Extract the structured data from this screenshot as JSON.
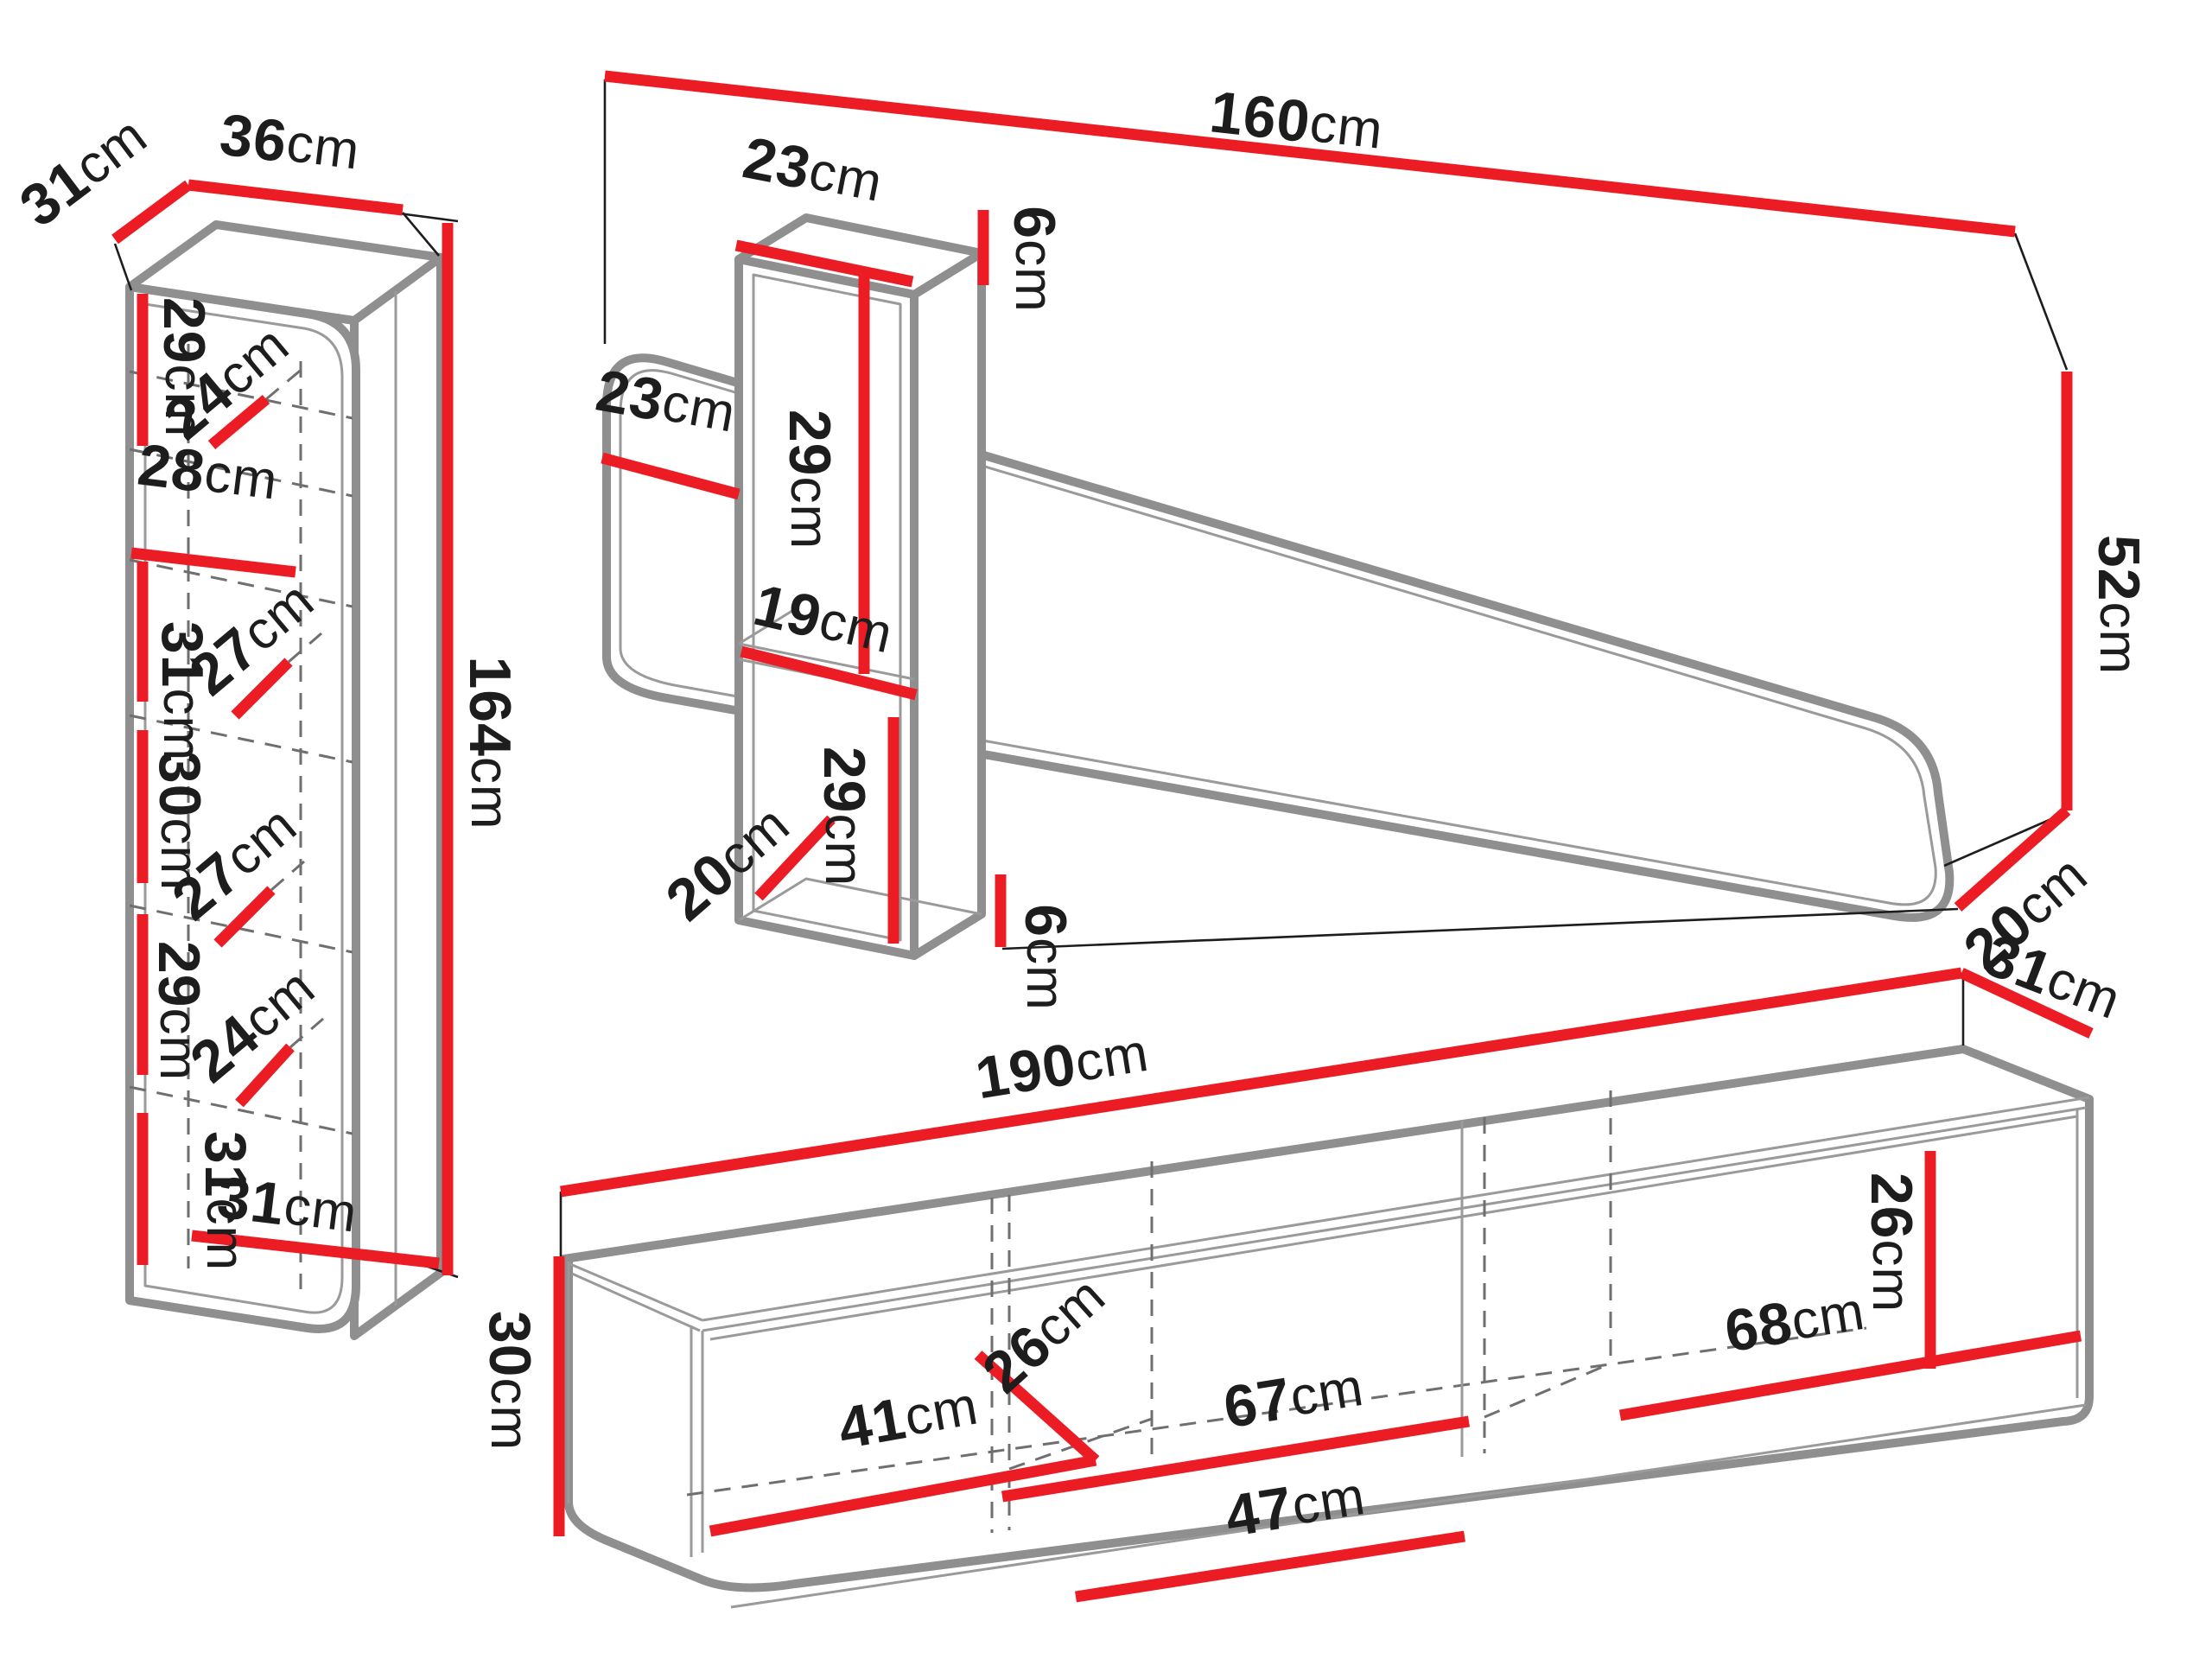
{
  "unit": "cm",
  "colors": {
    "dimension_line": "#ec1c24",
    "edge_gray": "#8f8f8f",
    "label_text": "#1d1d1d",
    "background": "#ffffff"
  },
  "pieces": {
    "cabinet": {
      "dims": {
        "depth_top": {
          "n": "31",
          "u": "cm"
        },
        "width_top": {
          "n": "36",
          "u": "cm"
        },
        "height": {
          "n": "164",
          "u": "cm"
        },
        "sec1_h": {
          "n": "29",
          "u": "cm"
        },
        "sec1_d": {
          "n": "24",
          "u": "cm"
        },
        "inner_width": {
          "n": "28",
          "u": "cm"
        },
        "sec2_h": {
          "n": "31",
          "u": "cm"
        },
        "sec2_d": {
          "n": "27",
          "u": "cm"
        },
        "sec3_h": {
          "n": "30",
          "u": "cm"
        },
        "sec3_d": {
          "n": "27",
          "u": "cm"
        },
        "sec4_h": {
          "n": "29",
          "u": "cm"
        },
        "sec4_d": {
          "n": "24",
          "u": "cm"
        },
        "sec5_h": {
          "n": "31",
          "u": "cm"
        },
        "width_bottom": {
          "n": "31",
          "u": "cm"
        }
      }
    },
    "headboard": {
      "dims": {
        "width": {
          "n": "160",
          "u": "cm"
        },
        "unit_width": {
          "n": "23",
          "u": "cm"
        },
        "gap_top": {
          "n": "6",
          "u": "cm"
        },
        "left_offset": {
          "n": "23",
          "u": "cm"
        },
        "unit_upper_h": {
          "n": "29",
          "u": "cm"
        },
        "shelf_width": {
          "n": "19",
          "u": "cm"
        },
        "unit_lower_h": {
          "n": "29",
          "u": "cm"
        },
        "unit_depth": {
          "n": "20",
          "u": "cm"
        },
        "gap_bottom": {
          "n": "6",
          "u": "cm"
        },
        "height": {
          "n": "52",
          "u": "cm"
        },
        "depth_bottom": {
          "n": "20",
          "u": "cm"
        }
      }
    },
    "tv_stand": {
      "dims": {
        "width": {
          "n": "190",
          "u": "cm"
        },
        "depth": {
          "n": "31",
          "u": "cm"
        },
        "height": {
          "n": "30",
          "u": "cm"
        },
        "comp1_width": {
          "n": "41",
          "u": "cm"
        },
        "comp1_depth": {
          "n": "26",
          "u": "cm"
        },
        "comp2_width": {
          "n": "67",
          "u": "cm"
        },
        "comp2_bottom": {
          "n": "47",
          "u": "cm"
        },
        "comp3_width": {
          "n": "68",
          "u": "cm"
        },
        "comp3_height": {
          "n": "26",
          "u": "cm"
        }
      }
    }
  }
}
